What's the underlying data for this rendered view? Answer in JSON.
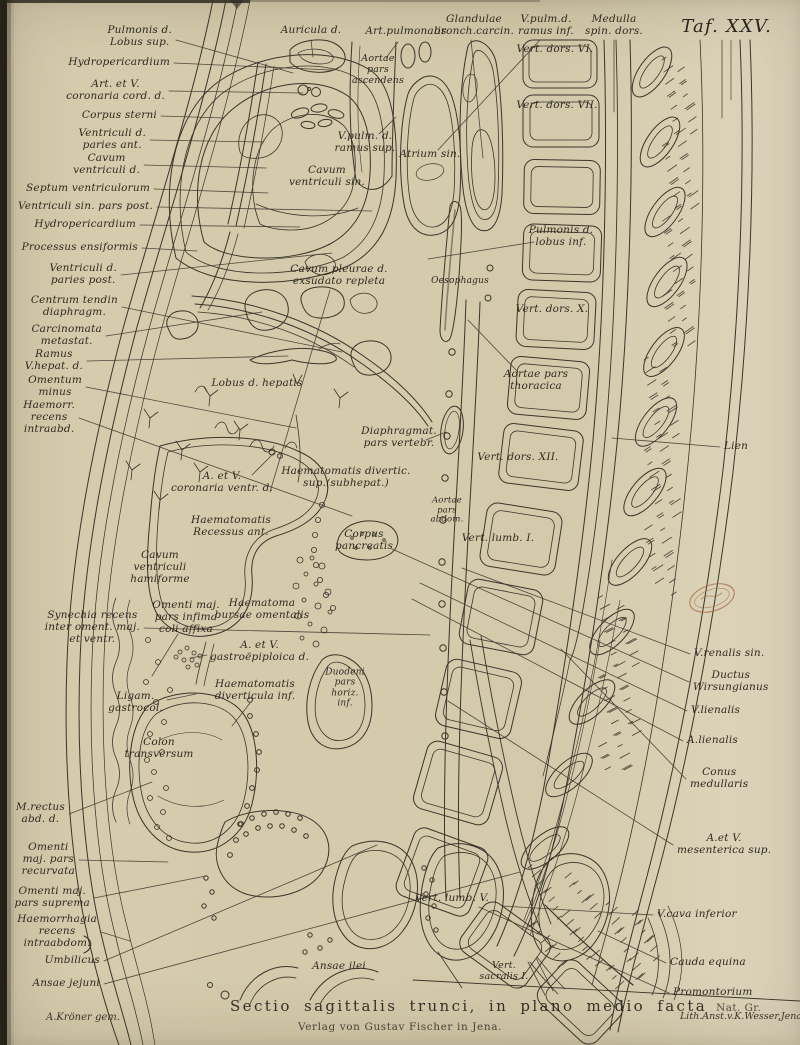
{
  "page": {
    "plate_title": "Taf. XXV."
  },
  "caption": {
    "main": "Sectio sagittalis trunci, in plano medio facta",
    "scale": "Nat. Gr.",
    "publisher": "Verlag von Gustav Fischer in Jena."
  },
  "credits": {
    "artist": "A.Kröner gem.",
    "lithographer": "Lith.Anst.v.K.Wesser,Jena."
  },
  "colors": {
    "paper": "#d6cbad",
    "ink": "#3a352b",
    "stamp": "#a5693f"
  },
  "labels": [
    {
      "t": "Pulmonis d.\nLobus sup.",
      "x": 172,
      "y": 37,
      "a": "r",
      "lead": [
        176,
        40,
        293,
        73
      ]
    },
    {
      "t": "Auricula d.",
      "x": 311,
      "y": 31,
      "a": "c",
      "lead": [
        311,
        40,
        313,
        57
      ]
    },
    {
      "t": "Art.pulmonalis",
      "x": 406,
      "y": 32,
      "a": "c",
      "lead": [
        398,
        42,
        386,
        58
      ]
    },
    {
      "t": "Glandulae\nbronch.carcin.",
      "x": 474,
      "y": 26,
      "a": "c",
      "lead": [
        471,
        40,
        483,
        158
      ]
    },
    {
      "t": "V.pulm.d.\nramus inf.",
      "x": 546,
      "y": 26,
      "a": "c",
      "lead": [
        540,
        40,
        438,
        150
      ]
    },
    {
      "t": "Medulla\nspin. dors.",
      "x": 614,
      "y": 26,
      "a": "c",
      "lead": [
        614,
        40,
        614,
        112
      ]
    },
    {
      "t": "Hydropericardium",
      "x": 170,
      "y": 63,
      "a": "r",
      "lead": [
        174,
        63,
        332,
        70
      ]
    },
    {
      "t": "Art. et V.\ncoronaria cord. d.",
      "x": 165,
      "y": 91,
      "a": "r",
      "lead": [
        169,
        91,
        303,
        93
      ]
    },
    {
      "t": "Corpus sterni",
      "x": 157,
      "y": 116,
      "a": "r",
      "lead": [
        161,
        116,
        224,
        118
      ]
    },
    {
      "t": "Ventriculi d.\nparies ant.",
      "x": 146,
      "y": 140,
      "a": "r",
      "lead": [
        150,
        140,
        264,
        142
      ]
    },
    {
      "t": "Cavum\nventriculi d.",
      "x": 140,
      "y": 165,
      "a": "r",
      "lead": [
        144,
        165,
        266,
        168
      ]
    },
    {
      "t": "Septum ventriculorum",
      "x": 150,
      "y": 189,
      "a": "r",
      "lead": [
        154,
        189,
        268,
        193
      ]
    },
    {
      "t": "Ventriculi sin. pars post.",
      "x": 153,
      "y": 207,
      "a": "r",
      "lead": [
        157,
        207,
        372,
        211
      ]
    },
    {
      "t": "Hydropericardium",
      "x": 136,
      "y": 225,
      "a": "r",
      "lead": [
        140,
        225,
        300,
        227
      ]
    },
    {
      "t": "Processus ensiformis",
      "x": 138,
      "y": 248,
      "a": "r",
      "lead": [
        142,
        248,
        197,
        251
      ]
    },
    {
      "t": "Ventriculi d.\nparies post.",
      "x": 117,
      "y": 275,
      "a": "r",
      "lead": [
        121,
        275,
        332,
        253
      ]
    },
    {
      "t": "Centrum tendin\ndiaphragm.",
      "x": 118,
      "y": 307,
      "a": "r",
      "lead": [
        122,
        307,
        342,
        352
      ]
    },
    {
      "t": "Carcinomata\nmetastat.",
      "x": 102,
      "y": 336,
      "a": "r",
      "lead": [
        106,
        336,
        262,
        312
      ]
    },
    {
      "t": "Ramus\nV.hepat. d.",
      "x": 83,
      "y": 361,
      "a": "r",
      "lead": [
        87,
        361,
        288,
        356
      ]
    },
    {
      "t": "Omentum\nminus",
      "x": 82,
      "y": 387,
      "a": "r",
      "lead": [
        86,
        387,
        296,
        428
      ]
    },
    {
      "t": "Haemorr.\nrecens\nintraabd.",
      "x": 75,
      "y": 418,
      "a": "r",
      "lead": [
        79,
        418,
        352,
        516
      ]
    },
    {
      "t": "Aortae\npars\nascendens",
      "x": 378,
      "y": 70,
      "a": "c",
      "fs": 9.5
    },
    {
      "t": "V.pulm. d.\nramus sup.",
      "x": 365,
      "y": 143,
      "a": "c",
      "lead": [
        379,
        134,
        396,
        117
      ]
    },
    {
      "t": "Atrium sin.",
      "x": 430,
      "y": 155,
      "a": "c"
    },
    {
      "t": "Cavum\nventriculi sin.",
      "x": 327,
      "y": 177,
      "a": "c"
    },
    {
      "t": "Vert. dors. VI.",
      "x": 555,
      "y": 50,
      "a": "c"
    },
    {
      "t": "Vert. dors. VII.",
      "x": 557,
      "y": 106,
      "a": "c"
    },
    {
      "t": "Pulmonis d.\nlobus inf.",
      "x": 561,
      "y": 237,
      "a": "c",
      "lead": [
        534,
        242,
        428,
        259
      ]
    },
    {
      "t": "Oesophagus",
      "x": 460,
      "y": 281,
      "a": "c",
      "fs": 9
    },
    {
      "t": "Cavum pleurae d.\nexsudato repleta",
      "x": 339,
      "y": 276,
      "a": "c",
      "lead": [
        330,
        290,
        270,
        492
      ]
    },
    {
      "t": "Vert. dors. X.",
      "x": 552,
      "y": 310,
      "a": "c"
    },
    {
      "t": "Aortae pars\nthoracica",
      "x": 536,
      "y": 381,
      "a": "c",
      "lead": [
        518,
        372,
        468,
        320
      ]
    },
    {
      "t": "Lobus d. hepatis",
      "x": 257,
      "y": 384,
      "a": "c"
    },
    {
      "t": "Diaphragmat.\npars vertebr.",
      "x": 399,
      "y": 438,
      "a": "c",
      "lead": [
        426,
        440,
        446,
        432
      ]
    },
    {
      "t": "Vert. dors. XII.",
      "x": 518,
      "y": 458,
      "a": "c"
    },
    {
      "t": "A. et V.\ncoronaria ventr. d.",
      "x": 222,
      "y": 483,
      "a": "c",
      "lead": [
        252,
        475,
        274,
        453
      ]
    },
    {
      "t": "Haematomatis divertic.\nsup.(subhepat.)",
      "x": 346,
      "y": 478,
      "a": "c"
    },
    {
      "t": "Aortae\npars\nabdom.",
      "x": 447,
      "y": 511,
      "a": "c",
      "fs": 8.5
    },
    {
      "t": "Haematomatis\nRecessus ant.",
      "x": 231,
      "y": 527,
      "a": "c"
    },
    {
      "t": "Corpus\npancreatis",
      "x": 364,
      "y": 541,
      "a": "c"
    },
    {
      "t": "Vert. lumb. I.",
      "x": 498,
      "y": 539,
      "a": "c"
    },
    {
      "t": "Cavum\nventriculi\nhamiforme",
      "x": 160,
      "y": 568,
      "a": "c"
    },
    {
      "t": "Haematoma\nbursae omentalis",
      "x": 262,
      "y": 610,
      "a": "c"
    },
    {
      "t": "Omenti maj.\npars infima\ncoli affixa",
      "x": 186,
      "y": 618,
      "a": "c",
      "lead": [
        178,
        634,
        152,
        676
      ]
    },
    {
      "t": "Synechia recens\ninter oment. maj.\net ventr.",
      "x": 140,
      "y": 628,
      "a": "r",
      "lead": [
        144,
        628,
        430,
        635
      ]
    },
    {
      "t": "A. et V.\ngastroëpiploica d.",
      "x": 210,
      "y": 652,
      "a": "l",
      "lead": [
        207,
        655,
        190,
        658
      ]
    },
    {
      "t": "Haematomatis\ndiverticula inf.",
      "x": 255,
      "y": 691,
      "a": "c",
      "lead": [
        250,
        703,
        232,
        726
      ]
    },
    {
      "t": "Duodeni\npars\nhoriz.\ninf.",
      "x": 345,
      "y": 688,
      "a": "c",
      "fs": 9
    },
    {
      "t": "Ligam.\ngastrocol.",
      "x": 163,
      "y": 703,
      "a": "r",
      "lead": [
        167,
        700,
        196,
        694
      ]
    },
    {
      "t": "Colon\ntransversum",
      "x": 159,
      "y": 749,
      "a": "c"
    },
    {
      "t": "Vert. lumb. V.",
      "x": 452,
      "y": 899,
      "a": "c"
    },
    {
      "t": "Ansae ilei",
      "x": 339,
      "y": 967,
      "a": "c"
    },
    {
      "t": "Vert.\nsacralis I.",
      "x": 504,
      "y": 972,
      "a": "c",
      "fs": 9.5
    },
    {
      "t": "M.rectus\nabd. d.",
      "x": 65,
      "y": 814,
      "a": "r",
      "lead": [
        69,
        814,
        152,
        782
      ]
    },
    {
      "t": "Omenti\nmaj. pars\nrecurvata",
      "x": 75,
      "y": 860,
      "a": "r",
      "lead": [
        79,
        860,
        168,
        862
      ]
    },
    {
      "t": "Omenti maj.\npars suprema",
      "x": 90,
      "y": 898,
      "a": "r",
      "lead": [
        94,
        898,
        206,
        876
      ]
    },
    {
      "t": "Haemorrhagia\nrecens\nintraabdom.",
      "x": 97,
      "y": 932,
      "a": "r",
      "lead": [
        101,
        932,
        130,
        941
      ]
    },
    {
      "t": "Umbilicus",
      "x": 100,
      "y": 961,
      "a": "r",
      "lead": [
        104,
        961,
        377,
        845
      ]
    },
    {
      "t": "Ansae jejuni",
      "x": 100,
      "y": 984,
      "a": "r",
      "lead": [
        104,
        984,
        520,
        872
      ]
    },
    {
      "t": "Lien",
      "x": 724,
      "y": 447,
      "a": "l",
      "lead": [
        720,
        447,
        612,
        438
      ]
    },
    {
      "t": "V.renalis sin.",
      "x": 694,
      "y": 654,
      "a": "l",
      "lead": [
        690,
        654,
        462,
        568
      ]
    },
    {
      "t": "Ductus\nWirsungianus",
      "x": 693,
      "y": 682,
      "a": "l",
      "lead": [
        689,
        682,
        392,
        549
      ]
    },
    {
      "t": "V.lienalis",
      "x": 691,
      "y": 711,
      "a": "l",
      "lead": [
        687,
        711,
        420,
        583
      ]
    },
    {
      "t": "A.lienalis",
      "x": 687,
      "y": 741,
      "a": "l",
      "lead": [
        683,
        741,
        412,
        599
      ]
    },
    {
      "t": "Conus\nmedullaris",
      "x": 690,
      "y": 779,
      "a": "l",
      "lead": [
        686,
        779,
        561,
        649
      ]
    },
    {
      "t": "A.et V.\nmesenterica sup.",
      "x": 677,
      "y": 845,
      "a": "l",
      "lead": [
        673,
        845,
        448,
        701
      ]
    },
    {
      "t": "V.cava inferior",
      "x": 657,
      "y": 915,
      "a": "l",
      "lead": [
        653,
        915,
        502,
        906
      ]
    },
    {
      "t": "Cauda equina",
      "x": 670,
      "y": 963,
      "a": "l",
      "lead": [
        666,
        963,
        598,
        931
      ]
    },
    {
      "t": "Promontorium",
      "x": 673,
      "y": 993,
      "a": "l",
      "lead": [
        669,
        993,
        479,
        907
      ]
    }
  ]
}
